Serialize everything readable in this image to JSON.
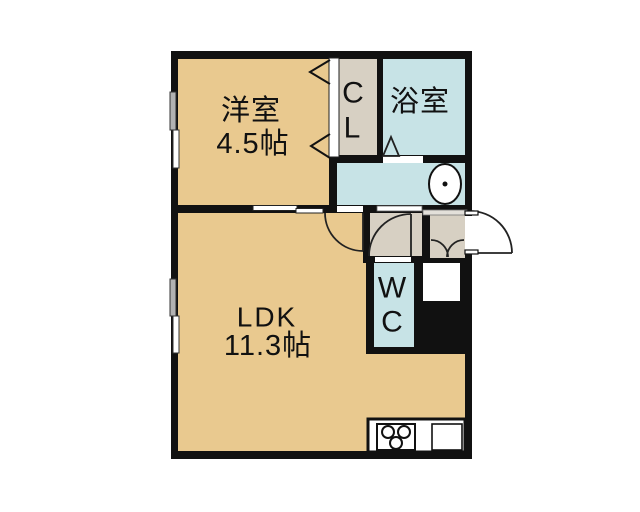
{
  "plan": {
    "rooms": {
      "western_room": {
        "name": "洋室",
        "size": "4.5帖"
      },
      "closet": {
        "label_line1": "C",
        "label_line2": "L"
      },
      "bathroom": {
        "name": "浴室"
      },
      "ldk": {
        "name": "LDK",
        "size": "11.3帖"
      },
      "toilet": {
        "label_line1": "W",
        "label_line2": "C"
      }
    },
    "colors": {
      "tatami_tan": "#e9c98f",
      "wet_area_cyan": "#c7e3e6",
      "hall_gray": "#d7d0c3",
      "wall_black": "#111111",
      "background": "#ffffff"
    }
  }
}
